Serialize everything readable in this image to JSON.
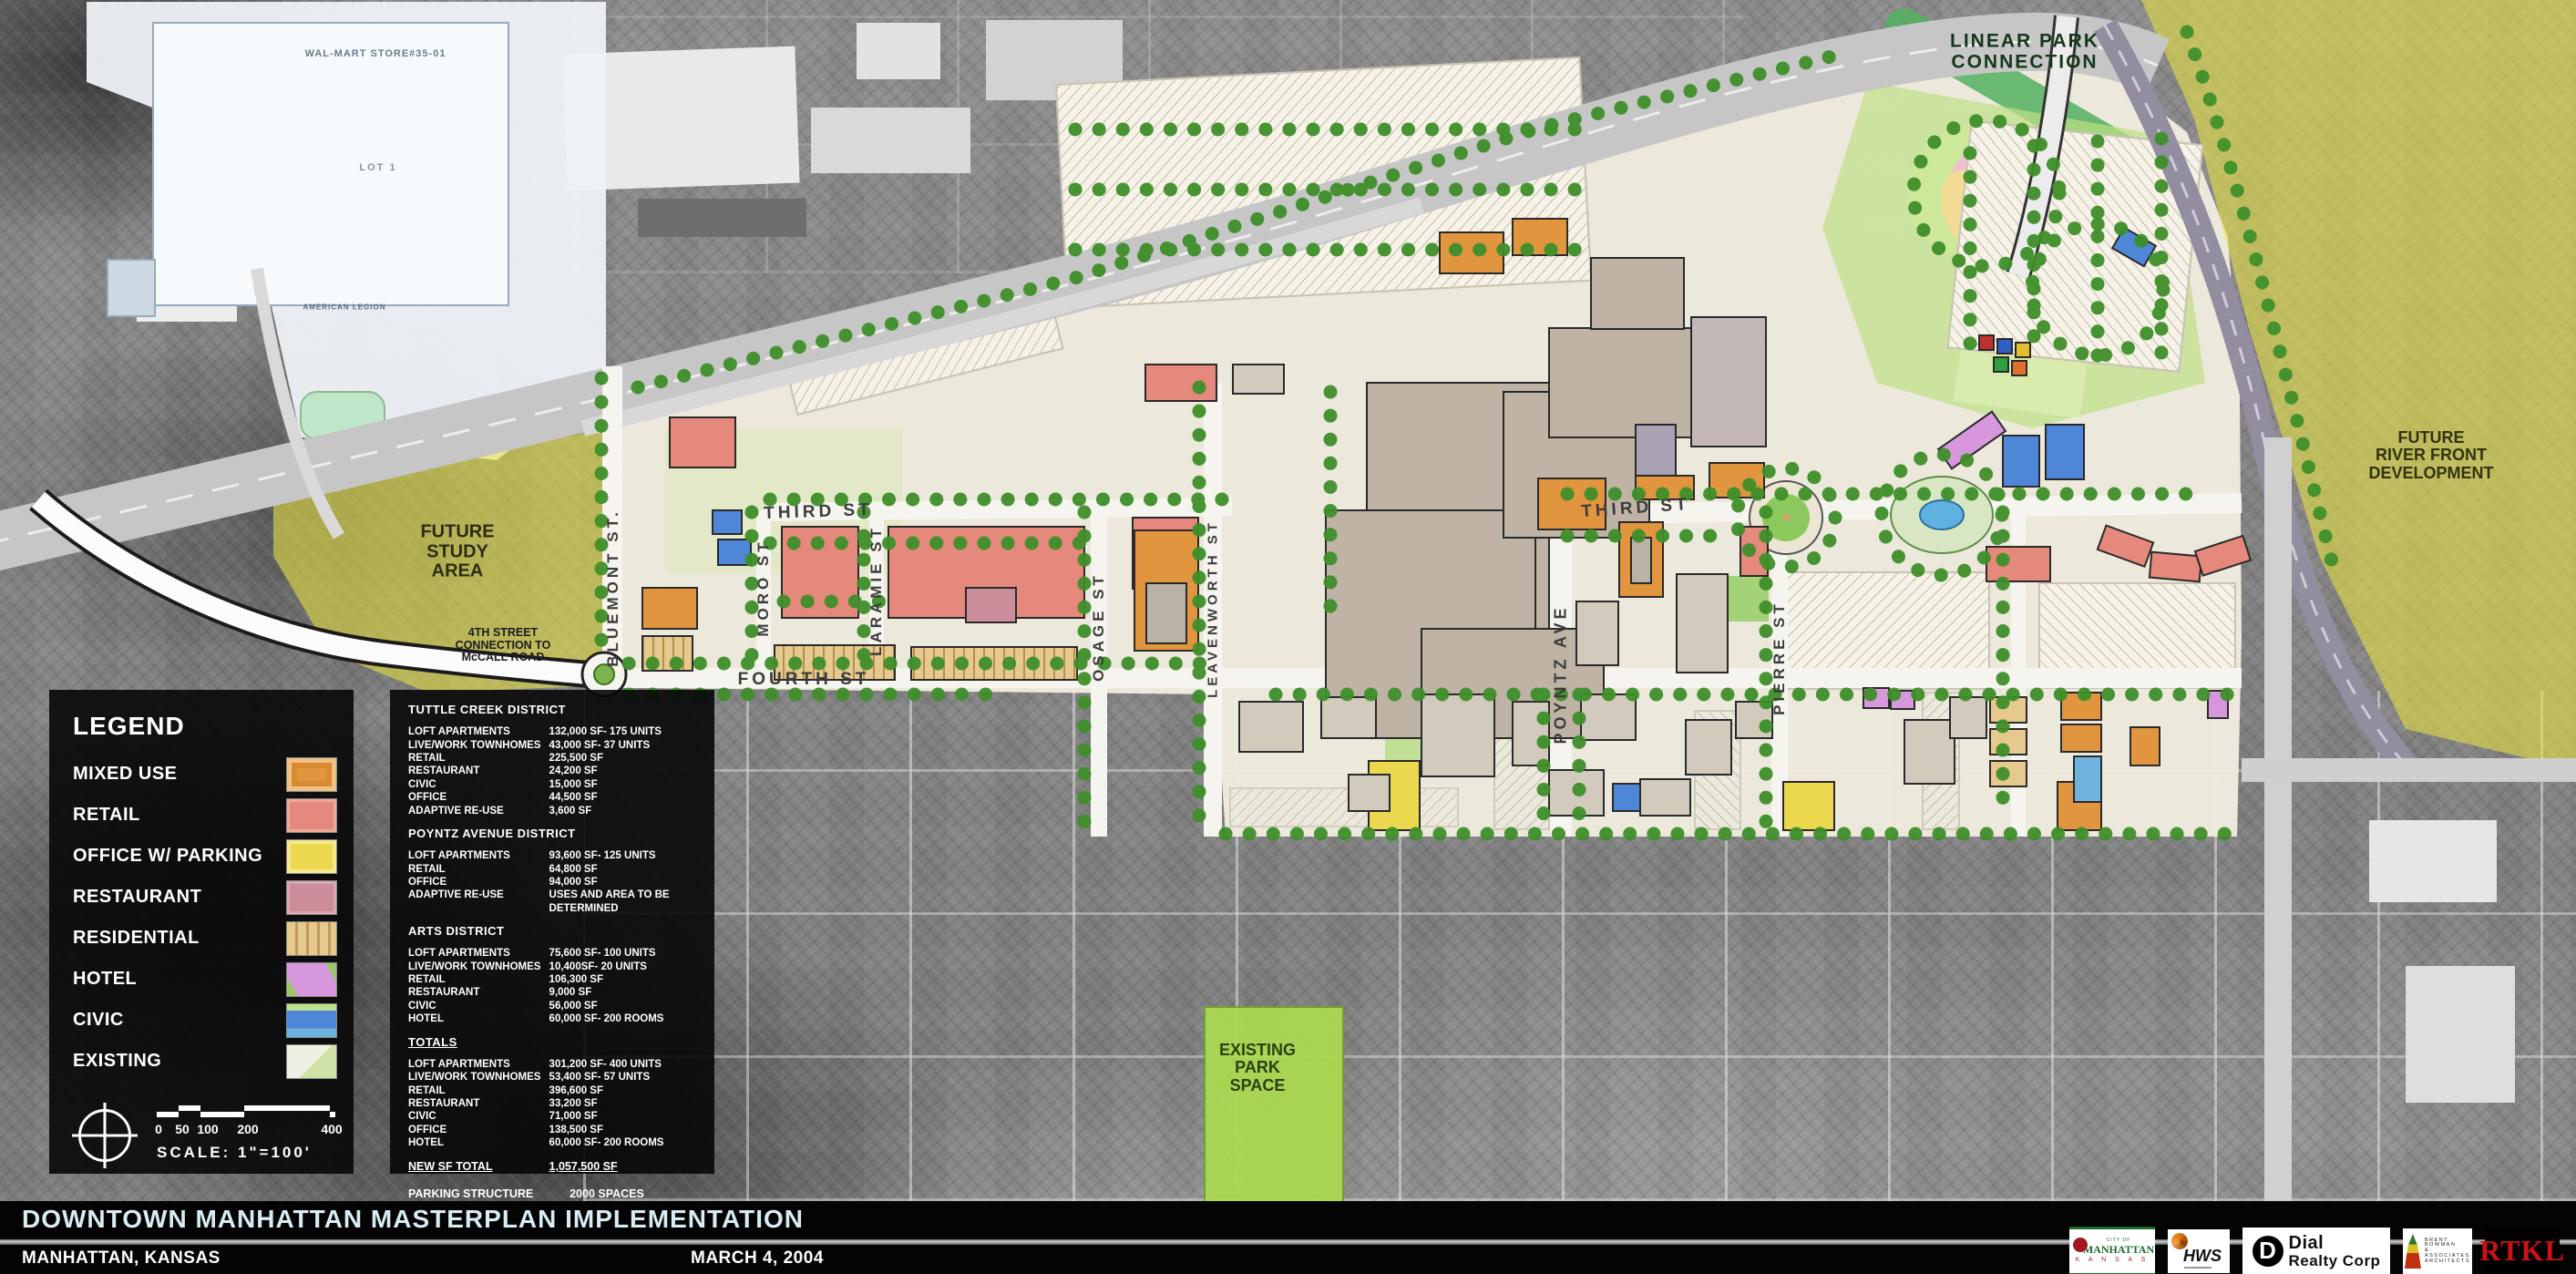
{
  "map": {
    "labels": {
      "linear_park": "LINEAR PARK\nCONNECTION",
      "river_front": "FUTURE\nRIVER FRONT\nDEVELOPMENT",
      "study_area": "FUTURE\nSTUDY\nAREA",
      "fourth_connection": "4TH STREET\nCONNECTION TO\nMcCALL ROAD",
      "existing_park": "EXISTING\nPARK\nSPACE",
      "walmart": "WAL-MART STORE#35-01",
      "lot1": "LOT 1",
      "american_legion": "AMERICAN LEGION"
    },
    "streets": {
      "third_w": "THIRD ST",
      "third_e": "THIRD ST",
      "fourth": "FOURTH ST",
      "moro": "MORO ST",
      "laramie": "LARAMIE ST",
      "osage": "OSAGE ST",
      "leavenworth": "LEAVENWORTH ST",
      "bluemont": "BLUEMONT ST.",
      "poyntz": "POYNTZ AVE",
      "pierre": "PIERRE ST"
    }
  },
  "legend": {
    "title": "LEGEND",
    "items": [
      {
        "key": "mixed",
        "label": "MIXED USE",
        "color": "#e2953f"
      },
      {
        "key": "retail",
        "label": "RETAIL",
        "color": "#e4897b"
      },
      {
        "key": "office",
        "label": "OFFICE W/ PARKING",
        "color": "#ecd84e"
      },
      {
        "key": "restaurant",
        "label": "RESTAURANT",
        "color": "#cb8d99"
      },
      {
        "key": "residential",
        "label": "RESIDENTIAL",
        "color": "#e6c98f"
      },
      {
        "key": "hotel",
        "label": "HOTEL",
        "color": "#d797dd"
      },
      {
        "key": "civic",
        "label": "CIVIC",
        "color": "#4f86d8"
      },
      {
        "key": "existing",
        "label": "EXISTING",
        "color": "#efefe4"
      }
    ],
    "scale_ticks": [
      "0",
      "50",
      "100",
      "200",
      "400"
    ],
    "scale_label": "SCALE: 1\"=100'"
  },
  "stats": {
    "districts": [
      {
        "name": "TUTTLE CREEK DISTRICT",
        "underline": false,
        "rows": [
          [
            "LOFT APARTMENTS",
            "132,000 SF- 175 UNITS"
          ],
          [
            "LIVE/WORK TOWNHOMES",
            "43,000 SF- 37 UNITS"
          ],
          [
            "RETAIL",
            "225,500 SF"
          ],
          [
            "RESTAURANT",
            "24,200 SF"
          ],
          [
            "CIVIC",
            "15,000 SF"
          ],
          [
            "OFFICE",
            "44,500 SF"
          ],
          [
            "ADAPTIVE RE-USE",
            "3,600 SF"
          ]
        ]
      },
      {
        "name": "POYNTZ AVENUE DISTRICT",
        "underline": false,
        "rows": [
          [
            "LOFT APARTMENTS",
            "93,600 SF- 125 UNITS"
          ],
          [
            "RETAIL",
            "64,800 SF"
          ],
          [
            "OFFICE",
            "94,000 SF"
          ],
          [
            "ADAPTIVE RE-USE",
            "USES AND AREA TO BE DETERMINED"
          ]
        ]
      },
      {
        "name": "ARTS DISTRICT",
        "underline": false,
        "rows": [
          [
            "LOFT APARTMENTS",
            "75,600 SF- 100 UNITS"
          ],
          [
            "LIVE/WORK TOWNHOMES",
            "10,400SF- 20 UNITS"
          ],
          [
            "RETAIL",
            "106,300 SF"
          ],
          [
            "RESTAURANT",
            "9,000 SF"
          ],
          [
            "CIVIC",
            "56,000 SF"
          ],
          [
            "HOTEL",
            "60,000 SF- 200 ROOMS"
          ]
        ]
      },
      {
        "name": "TOTALS",
        "underline": true,
        "rows": [
          [
            "LOFT APARTMENTS",
            "301,200 SF- 400 UNITS"
          ],
          [
            "LIVE/WORK TOWNHOMES",
            "53,400 SF- 57 UNITS"
          ],
          [
            "RETAIL",
            "396,600 SF"
          ],
          [
            "RESTAURANT",
            "33,200 SF"
          ],
          [
            "CIVIC",
            "71,000 SF"
          ],
          [
            "OFFICE",
            "138,500 SF"
          ],
          [
            "HOTEL",
            "60,000 SF- 200 ROOMS"
          ]
        ]
      }
    ],
    "new_sf_total": {
      "label": "NEW SF TOTAL",
      "value": "1,057,500 SF"
    },
    "parking": [
      [
        "PARKING STRUCTURE SPACES",
        "2000 SPACES"
      ],
      [
        "PARKING LOT SPACES",
        "1630 SPACES"
      ]
    ],
    "footnote": "ALL NUMBERS ABOVE ARE APPROXIMATE ESTIMATES"
  },
  "footer": {
    "title": "DOWNTOWN MANHATTAN MASTERPLAN IMPLEMENTATION",
    "location": "MANHATTAN, KANSAS",
    "date": "MARCH 4, 2004",
    "logos": [
      {
        "id": "city-of-manhattan",
        "lines": [
          "CITY OF",
          "MANHATTAN",
          "K A N S A S"
        ]
      },
      {
        "id": "hws",
        "lines": [
          "HWS"
        ]
      },
      {
        "id": "dial-realty",
        "lines": [
          "Dial",
          "Realty Corp"
        ]
      },
      {
        "id": "brent-bowman",
        "lines": [
          "BRENT",
          "BOWMAN",
          "& ASSOCIATES",
          "ARCHITECTS"
        ]
      },
      {
        "id": "rtkl",
        "lines": [
          "RTKL"
        ]
      }
    ]
  },
  "colors": {
    "aerial_gray": "#8a8a8a",
    "plan_cream": "#f0ebdf",
    "tree_green": "#3f8f2a",
    "lawn_green": "#bfe085",
    "highlight_yellow": "#e8e243",
    "park_green": "#abdb4f",
    "linear_park_green": "#54b060",
    "retail_salmon": "#e4897b",
    "mixed_orange": "#e2953f",
    "office_yellow": "#ecd84e",
    "restaurant_mauve": "#cb8d99",
    "residential_tan": "#e6c98f",
    "hotel_violet": "#d797dd",
    "civic_blue": "#4f86d8",
    "existing_gray": "#d2cbbd",
    "mall_taupe": "#beb3a5",
    "title_text": "#d8ecf3"
  }
}
